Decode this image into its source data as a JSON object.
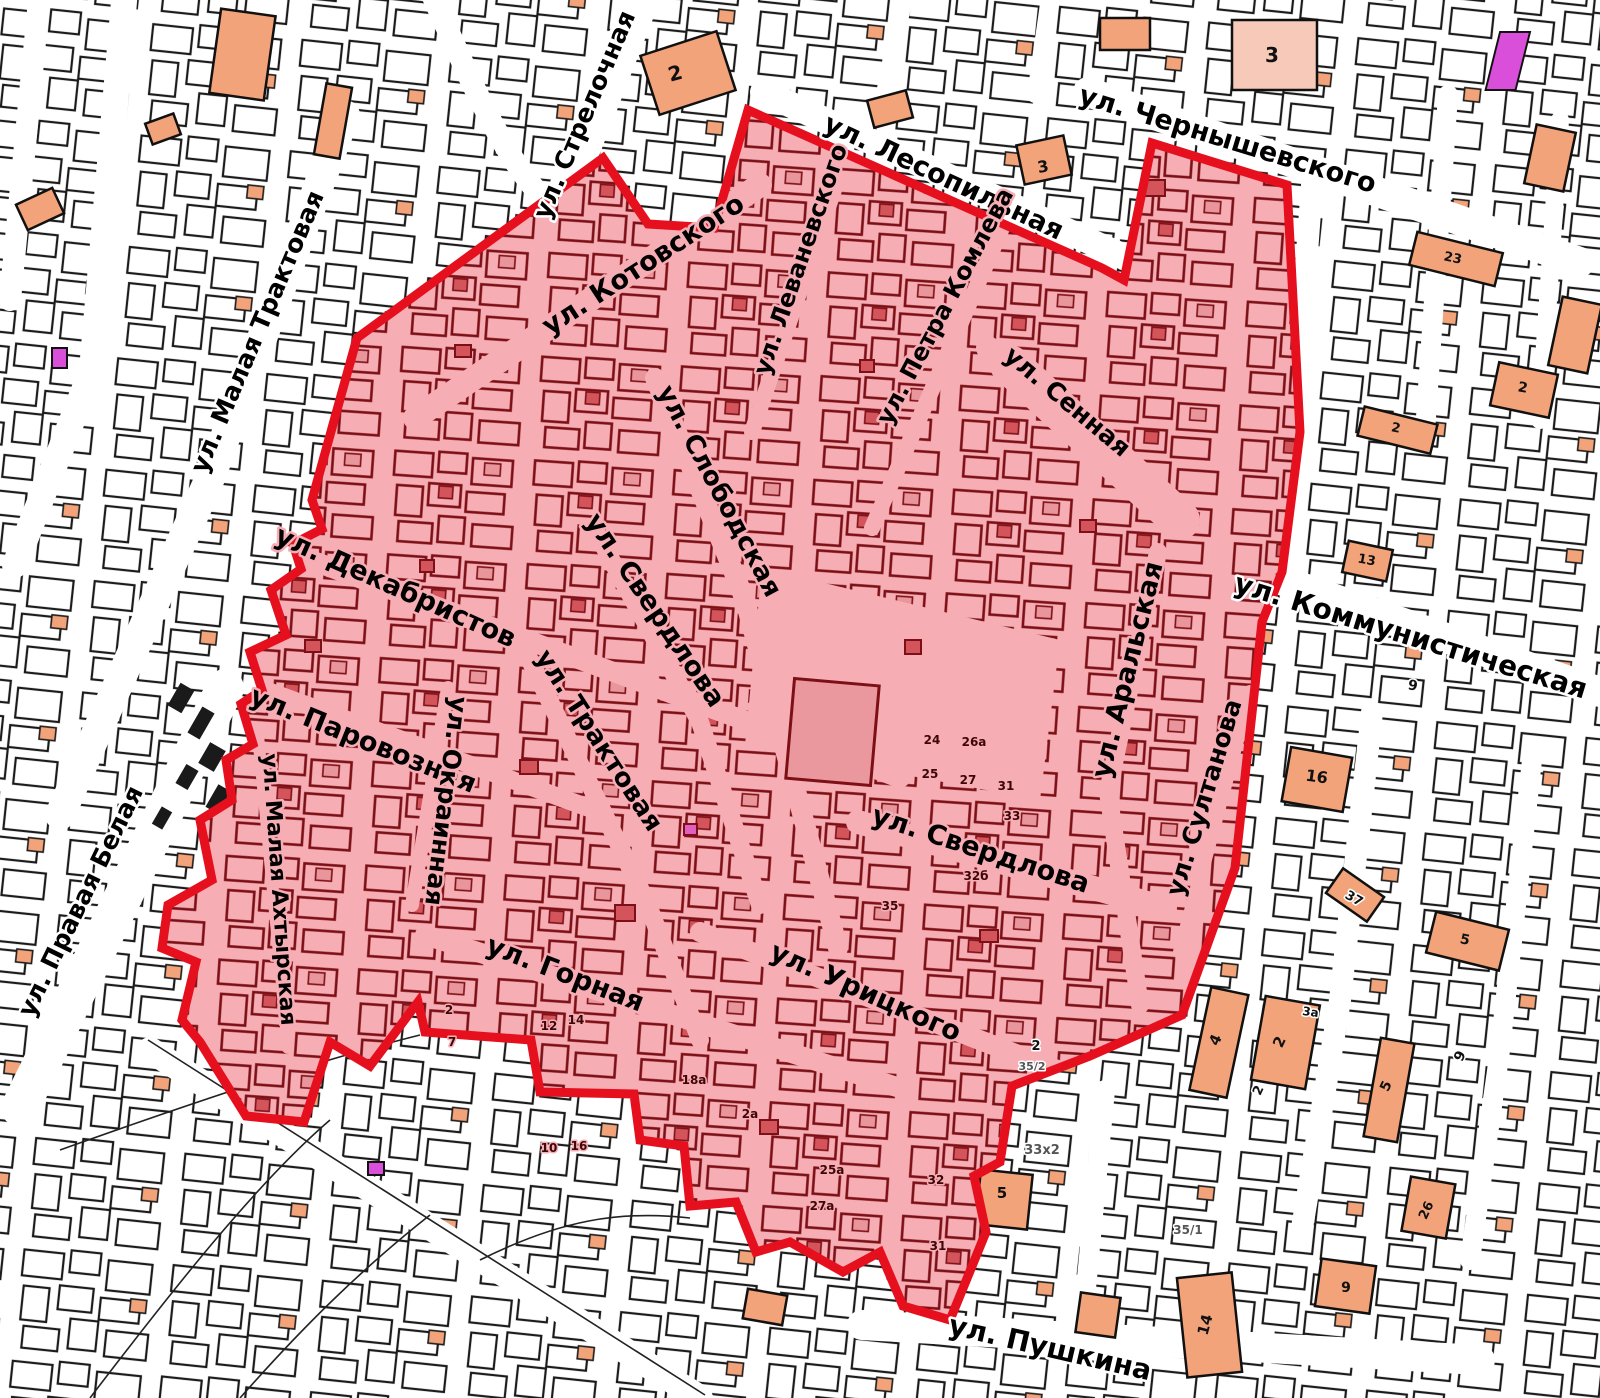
{
  "map": {
    "title": "Кадастровый план с выделенной зоной",
    "colors": {
      "zone_fill": "#f6adb4",
      "zone_border": "#e60f1e",
      "zone_parcel_stroke": "#7d1016",
      "zone_parcel_accent": "#d4545c",
      "outside_parcel_stroke": "#1b1b1b",
      "salmon_building": "#f2a379",
      "pale_building": "#f6c9b8",
      "magenta_building": "#d94fd9",
      "road": "#ffffff"
    },
    "zone": {
      "points": "357,338 603,158 648,224 714,228 748,110 1102,268 1124,280 1152,143 1287,185 1300,432 1282,572 1262,622 1235,868 1182,1015 1090,1056 1012,1086 1000,1162 974,1176 986,1232 950,1320 903,1306 880,1252 843,1272 790,1242 756,1252 736,1202 690,1206 684,1146 640,1140 634,1094 540,1092 531,1040 425,1032 418,1002 370,1066 330,1042 304,1122 246,1116 200,1042 182,1020 196,962 162,948 168,905 212,880 200,820 232,800 226,760 253,744 241,704 262,690 250,652 286,635 271,590 301,569 293,544 322,529 312,500"
    },
    "street_labels": [
      {
        "label": "ул. Стрелочная",
        "x": 592,
        "y": 118,
        "rot": -67,
        "size": 25,
        "halo": "#ffffff"
      },
      {
        "label": "ул. Лесопильная",
        "x": 940,
        "y": 185,
        "rot": 25,
        "size": 27,
        "halo": "#ffffff"
      },
      {
        "label": "ул. Чернышевского",
        "x": 1225,
        "y": 148,
        "rot": 17,
        "size": 27,
        "halo": "#ffffff"
      },
      {
        "label": "ул. Коммунистическая",
        "x": 1408,
        "y": 645,
        "rot": 17,
        "size": 28,
        "halo": "#ffffff"
      },
      {
        "label": "ул. Малая Трактовая",
        "x": 265,
        "y": 335,
        "rot": -67,
        "size": 25,
        "halo": "#ffffff"
      },
      {
        "label": "ул. Правая Белая",
        "x": 88,
        "y": 905,
        "rot": -64,
        "size": 25,
        "halo": "#ffffff"
      },
      {
        "label": "ул. Пушкина",
        "x": 1048,
        "y": 1357,
        "rot": 13,
        "size": 28,
        "halo": "#ffffff"
      },
      {
        "label": "ул. Котовского",
        "x": 648,
        "y": 272,
        "rot": -33,
        "size": 27,
        "halo": "#f6adb4"
      },
      {
        "label": "ул. Леваневского",
        "x": 808,
        "y": 262,
        "rot": -71,
        "size": 24,
        "halo": "#f6adb4"
      },
      {
        "label": "ул. Петра Комлева",
        "x": 952,
        "y": 310,
        "rot": -62,
        "size": 24,
        "halo": "#f6adb4"
      },
      {
        "label": "ул. Сенная",
        "x": 1062,
        "y": 408,
        "rot": 40,
        "size": 25,
        "halo": "#f6adb4"
      },
      {
        "label": "ул. Слободская",
        "x": 712,
        "y": 495,
        "rot": 62,
        "size": 26,
        "halo": "#f6adb4"
      },
      {
        "label": "ул. Свердлова",
        "x": 648,
        "y": 615,
        "rot": 56,
        "size": 27,
        "halo": "#f6adb4"
      },
      {
        "label": "ул. Трактовая",
        "x": 592,
        "y": 745,
        "rot": 57,
        "size": 26,
        "halo": "#f6adb4"
      },
      {
        "label": "ул. Декабристов",
        "x": 392,
        "y": 595,
        "rot": 24,
        "size": 27,
        "halo": "#f6adb4"
      },
      {
        "label": "ул. Паровозная",
        "x": 360,
        "y": 748,
        "rot": 22,
        "size": 27,
        "halo": "#f6adb4"
      },
      {
        "label": "ул. Окраинная",
        "x": 438,
        "y": 800,
        "rot": 97,
        "size": 25,
        "halo": "#f6adb4"
      },
      {
        "label": "ул. Малая Ахтырская",
        "x": 272,
        "y": 890,
        "rot": 86,
        "size": 22,
        "halo": "#f6adb4"
      },
      {
        "label": "ул. Аральская",
        "x": 1136,
        "y": 672,
        "rot": -76,
        "size": 27,
        "halo": "#f6adb4"
      },
      {
        "label": "ул. Султанова",
        "x": 1212,
        "y": 800,
        "rot": -73,
        "size": 25,
        "halo": "#f6adb4"
      },
      {
        "label": "ул. Свердлова",
        "x": 978,
        "y": 858,
        "rot": 18,
        "size": 27,
        "halo": "#f6adb4"
      },
      {
        "label": "ул. Урицкого",
        "x": 862,
        "y": 1000,
        "rot": 24,
        "size": 27,
        "halo": "#f6adb4"
      },
      {
        "label": "ул. Горная",
        "x": 562,
        "y": 982,
        "rot": 21,
        "size": 27,
        "halo": "#f6adb4"
      }
    ],
    "building_numbers": [
      {
        "text": "2",
        "x": 677,
        "y": 80,
        "size": 20,
        "rot": -15,
        "color": "#111111",
        "halo": "#f2a379"
      },
      {
        "text": "3",
        "x": 1044,
        "y": 172,
        "size": 16,
        "rot": -10,
        "color": "#111111",
        "halo": "#f2a379"
      },
      {
        "text": "3",
        "x": 1272,
        "y": 62,
        "size": 20,
        "rot": 0,
        "color": "#111111",
        "halo": "#f6c9b8"
      },
      {
        "text": "23",
        "x": 1452,
        "y": 262,
        "size": 13,
        "rot": 12,
        "color": "#111111",
        "halo": "#f2a379"
      },
      {
        "text": "2",
        "x": 1522,
        "y": 392,
        "size": 14,
        "rot": 10,
        "color": "#111111",
        "halo": "#f2a379"
      },
      {
        "text": "2",
        "x": 1395,
        "y": 432,
        "size": 13,
        "rot": 12,
        "color": "#111111",
        "halo": "#f2a379"
      },
      {
        "text": "13",
        "x": 1366,
        "y": 564,
        "size": 13,
        "rot": 10,
        "color": "#111111",
        "halo": "#f2a379"
      },
      {
        "text": "9",
        "x": 1412,
        "y": 690,
        "size": 14,
        "rot": 10,
        "color": "#111111",
        "halo": "#ffffff"
      },
      {
        "text": "16",
        "x": 1316,
        "y": 782,
        "size": 16,
        "rot": 8,
        "color": "#111111",
        "halo": "#f2a379"
      },
      {
        "text": "37",
        "x": 1352,
        "y": 902,
        "size": 13,
        "rot": 30,
        "color": "#111111",
        "halo": "#ffffff"
      },
      {
        "text": "5",
        "x": 1464,
        "y": 944,
        "size": 14,
        "rot": 12,
        "color": "#111111",
        "halo": "#f2a379"
      },
      {
        "text": "4",
        "x": 1220,
        "y": 1042,
        "size": 15,
        "rot": -65,
        "color": "#111111",
        "halo": "#f2a379"
      },
      {
        "text": "2",
        "x": 1284,
        "y": 1044,
        "size": 15,
        "rot": -65,
        "color": "#111111",
        "halo": "#f2a379"
      },
      {
        "text": "2",
        "x": 1262,
        "y": 1092,
        "size": 13,
        "rot": -65,
        "color": "#111111",
        "halo": "#ffffff"
      },
      {
        "text": "3а",
        "x": 1310,
        "y": 1016,
        "size": 12,
        "rot": 8,
        "color": "#111111",
        "halo": "#ffffff"
      },
      {
        "text": "5",
        "x": 1390,
        "y": 1088,
        "size": 14,
        "rot": -65,
        "color": "#111111",
        "halo": "#f2a379"
      },
      {
        "text": "9",
        "x": 1464,
        "y": 1058,
        "size": 14,
        "rot": -65,
        "color": "#111111",
        "halo": "#ffffff"
      },
      {
        "text": "26",
        "x": 1430,
        "y": 1212,
        "size": 13,
        "rot": -65,
        "color": "#111111",
        "halo": "#f2a379"
      },
      {
        "text": "5",
        "x": 1002,
        "y": 1198,
        "size": 15,
        "rot": 0,
        "color": "#111111",
        "halo": "#f2a379"
      },
      {
        "text": "2",
        "x": 1036,
        "y": 1050,
        "size": 13,
        "rot": 0,
        "color": "#111111",
        "halo": "#ffffff"
      },
      {
        "text": "14",
        "x": 1210,
        "y": 1326,
        "size": 15,
        "rot": -75,
        "color": "#111111",
        "halo": "#f2a379"
      },
      {
        "text": "9",
        "x": 1346,
        "y": 1292,
        "size": 14,
        "rot": 0,
        "color": "#111111",
        "halo": "#f2a379"
      },
      {
        "text": "24",
        "x": 932,
        "y": 744,
        "size": 12,
        "rot": 0,
        "color": "#3f0608",
        "halo": "#f6adb4"
      },
      {
        "text": "26а",
        "x": 974,
        "y": 746,
        "size": 12,
        "rot": 0,
        "color": "#3f0608",
        "halo": "#f6adb4"
      },
      {
        "text": "25",
        "x": 930,
        "y": 778,
        "size": 12,
        "rot": 0,
        "color": "#3f0608",
        "halo": "#f6adb4"
      },
      {
        "text": "27",
        "x": 968,
        "y": 784,
        "size": 12,
        "rot": 0,
        "color": "#3f0608",
        "halo": "#f6adb4"
      },
      {
        "text": "31",
        "x": 1006,
        "y": 790,
        "size": 12,
        "rot": 0,
        "color": "#3f0608",
        "halo": "#f6adb4"
      },
      {
        "text": "32б",
        "x": 976,
        "y": 880,
        "size": 12,
        "rot": 0,
        "color": "#3f0608",
        "halo": "#f6adb4"
      },
      {
        "text": "35",
        "x": 890,
        "y": 910,
        "size": 12,
        "rot": 0,
        "color": "#3f0608",
        "halo": "#f6adb4"
      },
      {
        "text": "2",
        "x": 449,
        "y": 1014,
        "size": 12,
        "rot": 0,
        "color": "#3f0608",
        "halo": "#f6adb4"
      },
      {
        "text": "7",
        "x": 452,
        "y": 1046,
        "size": 12,
        "rot": 0,
        "color": "#3f0608",
        "halo": "#f6adb4"
      },
      {
        "text": "12",
        "x": 549,
        "y": 1030,
        "size": 12,
        "rot": 0,
        "color": "#3f0608",
        "halo": "#f6adb4"
      },
      {
        "text": "14",
        "x": 576,
        "y": 1024,
        "size": 12,
        "rot": 0,
        "color": "#3f0608",
        "halo": "#f6adb4"
      },
      {
        "text": "10",
        "x": 549,
        "y": 1152,
        "size": 12,
        "rot": 0,
        "color": "#3f0608",
        "halo": "#f6adb4"
      },
      {
        "text": "16",
        "x": 579,
        "y": 1150,
        "size": 12,
        "rot": 0,
        "color": "#3f0608",
        "halo": "#f6adb4"
      },
      {
        "text": "18а",
        "x": 694,
        "y": 1084,
        "size": 12,
        "rot": 0,
        "color": "#3f0608",
        "halo": "#f6adb4"
      },
      {
        "text": "25а",
        "x": 832,
        "y": 1174,
        "size": 12,
        "rot": 0,
        "color": "#3f0608",
        "halo": "#f6adb4"
      },
      {
        "text": "27а",
        "x": 822,
        "y": 1210,
        "size": 12,
        "rot": 0,
        "color": "#3f0608",
        "halo": "#f6adb4"
      },
      {
        "text": "32",
        "x": 936,
        "y": 1184,
        "size": 12,
        "rot": 0,
        "color": "#3f0608",
        "halo": "#f6adb4"
      },
      {
        "text": "31",
        "x": 938,
        "y": 1250,
        "size": 12,
        "rot": 0,
        "color": "#3f0608",
        "halo": "#f6adb4"
      },
      {
        "text": "33",
        "x": 1012,
        "y": 820,
        "size": 12,
        "rot": 0,
        "color": "#3f0608",
        "halo": "#f6adb4"
      },
      {
        "text": "2а",
        "x": 750,
        "y": 1118,
        "size": 12,
        "rot": 0,
        "color": "#3f0608",
        "halo": "#f6adb4"
      },
      {
        "text": "33х2",
        "x": 1042,
        "y": 1154,
        "size": 13,
        "rot": 0,
        "color": "#555555",
        "halo": "#ffffff"
      },
      {
        "text": "35/1",
        "x": 1188,
        "y": 1234,
        "size": 12,
        "rot": 0,
        "color": "#555555",
        "halo": "#ffffff"
      },
      {
        "text": "35/2",
        "x": 1032,
        "y": 1070,
        "size": 11,
        "rot": 0,
        "color": "#555555",
        "halo": "#ffffff"
      }
    ]
  }
}
